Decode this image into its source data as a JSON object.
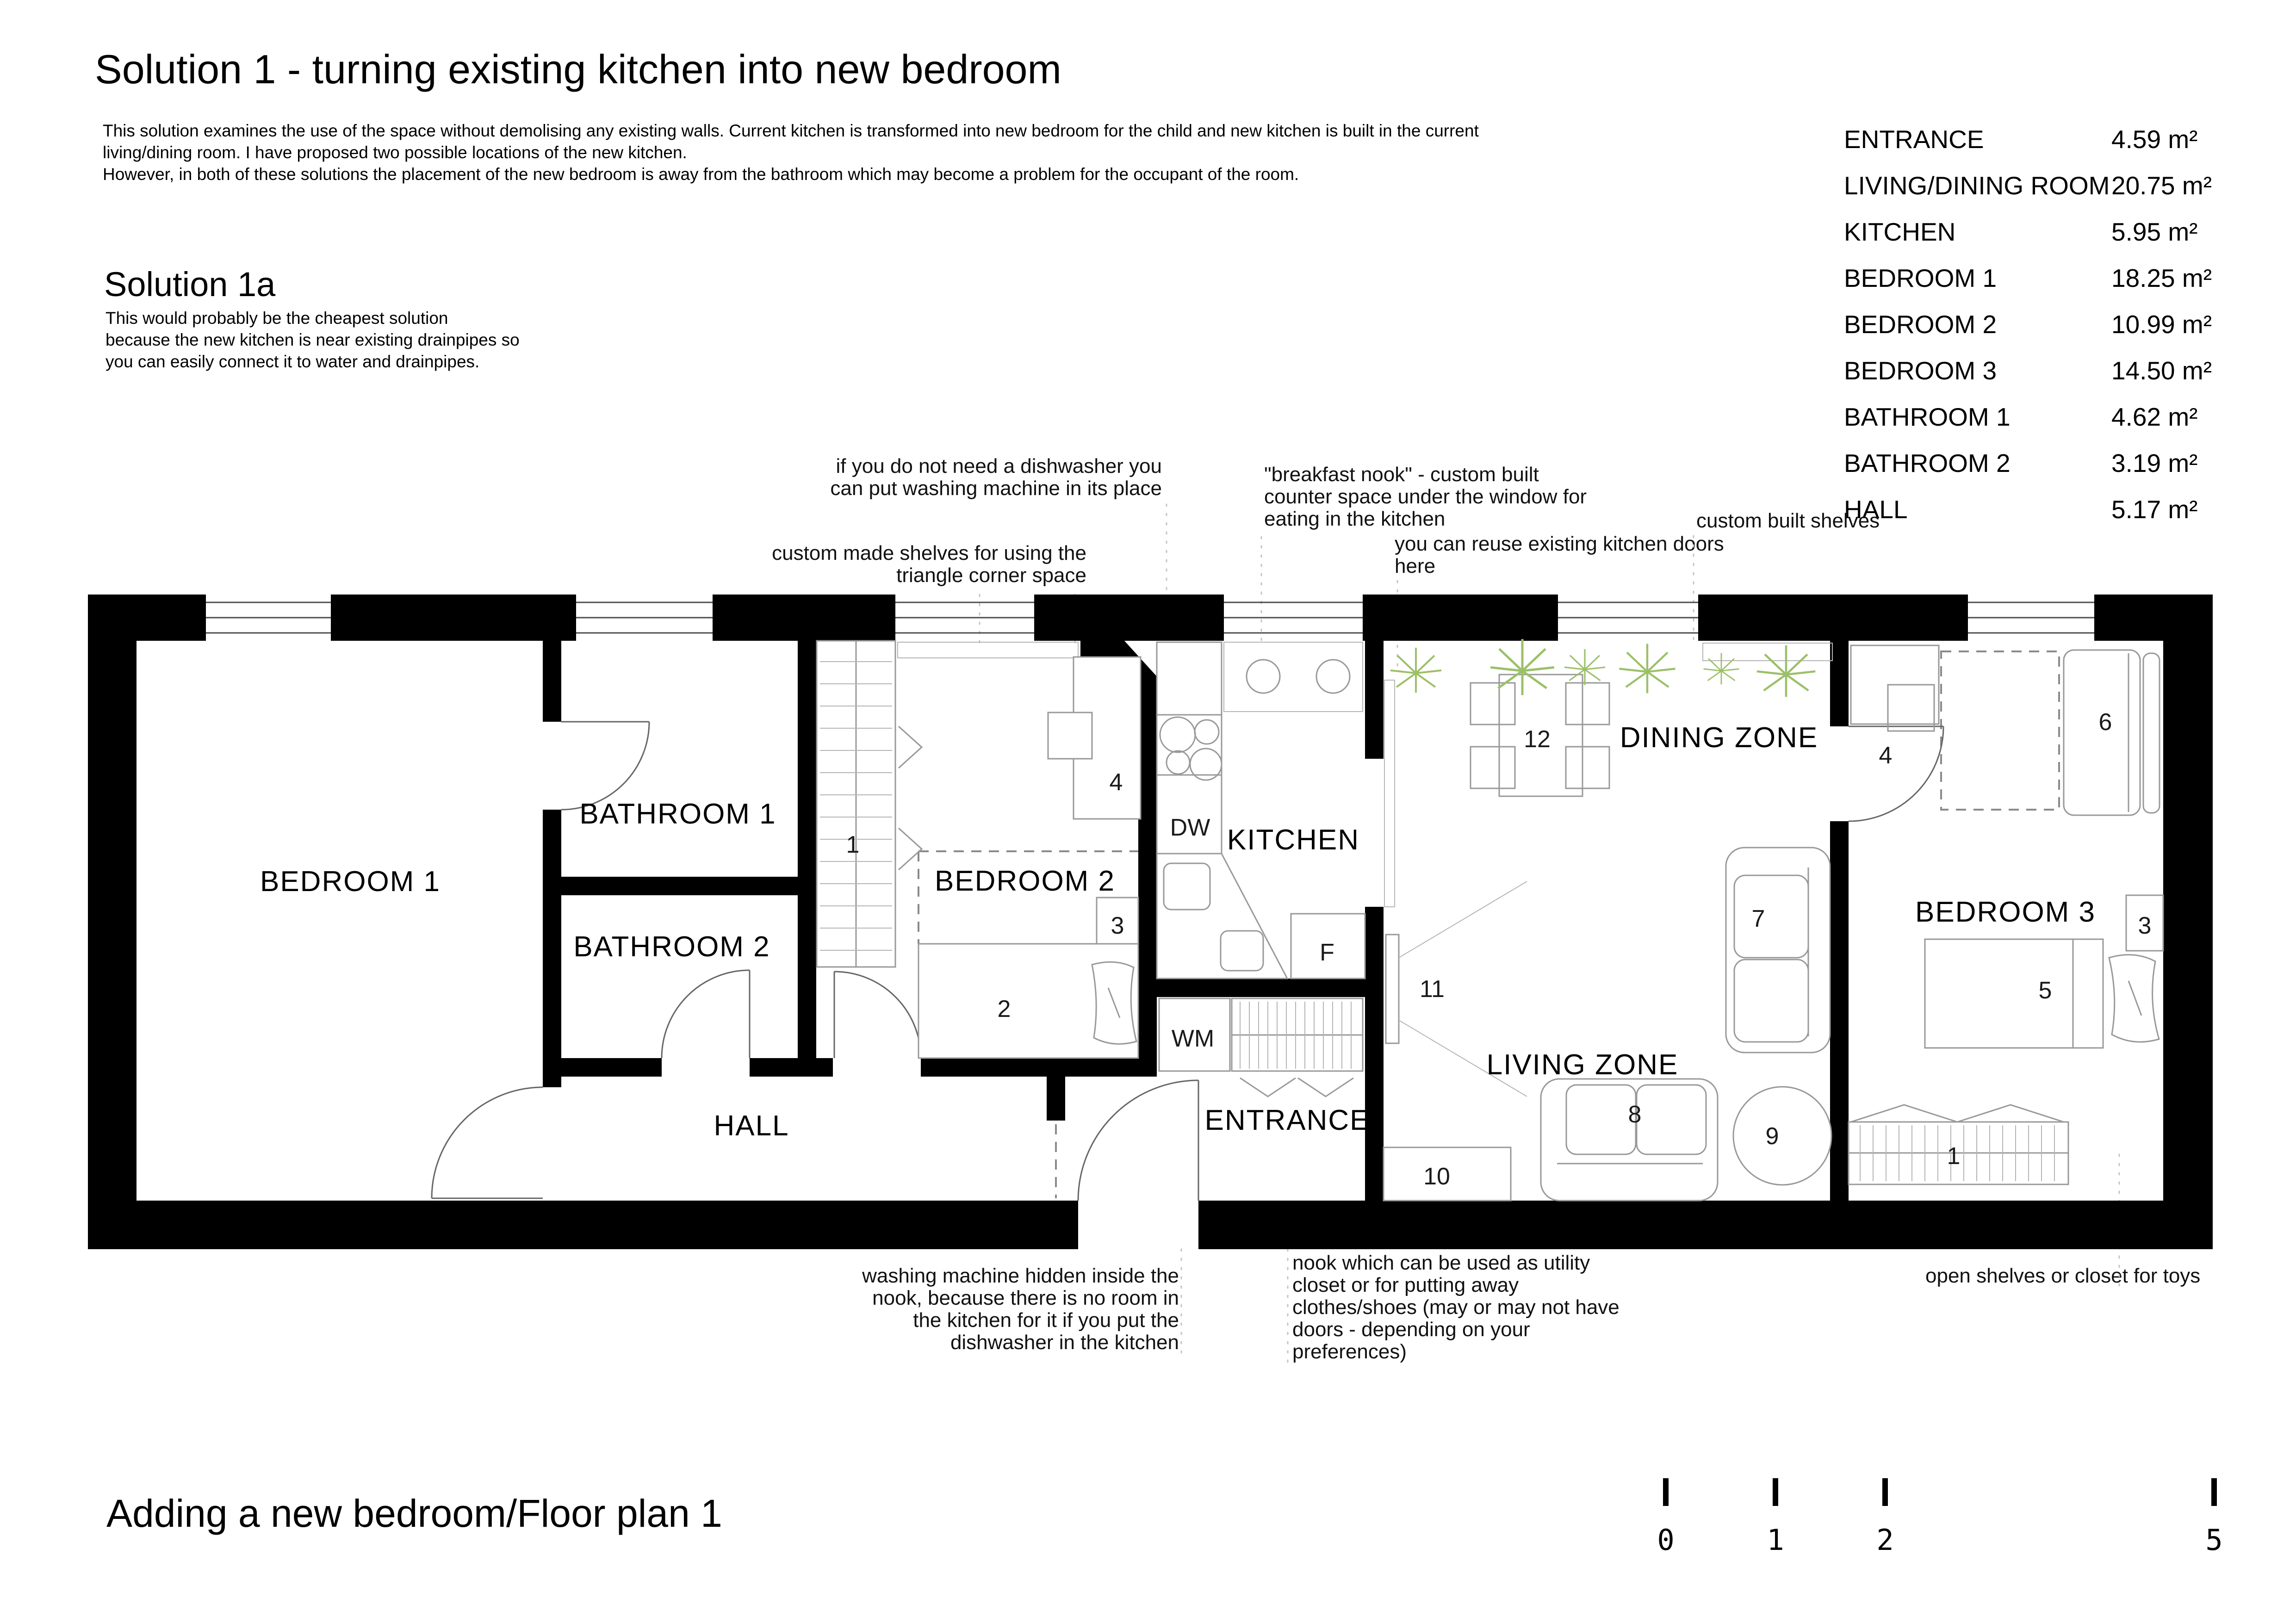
{
  "header": {
    "title": "Solution 1 - turning existing kitchen into new bedroom",
    "intro": [
      "This solution examines the use of the space without demolising any existing walls. Current kitchen is transformed into new bedroom for the child and new kitchen is built in the current",
      "living/dining room. I have proposed two possible locations of the new kitchen.",
      "However, in both of these solutions the placement of the new bedroom is away from the bathroom which may become a problem for the occupant of the room."
    ],
    "solution_1a_title": "Solution 1a",
    "solution_1a_lines": [
      "This would probably be the cheapest solution",
      "because the new kitchen is near existing drainpipes so",
      "you can easily connect it to water and drainpipes."
    ]
  },
  "areas": {
    "rows": [
      {
        "room": "ENTRANCE",
        "area": "4.59 m²"
      },
      {
        "room": "LIVING/DINING ROOM",
        "area": "20.75 m²"
      },
      {
        "room": "KITCHEN",
        "area": "5.95 m²"
      },
      {
        "room": "BEDROOM 1",
        "area": "18.25 m²"
      },
      {
        "room": "BEDROOM 2",
        "area": "10.99 m²"
      },
      {
        "room": "BEDROOM 3",
        "area": "14.50 m²"
      },
      {
        "room": "BATHROOM 1",
        "area": "4.62 m²"
      },
      {
        "room": "BATHROOM 2",
        "area": "3.19 m²"
      },
      {
        "room": "HALL",
        "area": "5.17 m²"
      }
    ]
  },
  "annotations": {
    "dishwasher": [
      "if you do not need a dishwasher you",
      "can put washing machine in its place"
    ],
    "corner_shelves": [
      "custom made shelves for using the",
      "triangle corner space"
    ],
    "breakfast_nook": [
      "\"breakfast nook\" - custom built",
      "counter space under the window for",
      "eating in the kitchen"
    ],
    "reuse_doors": [
      "you can reuse existing kitchen doors",
      "here"
    ],
    "custom_shelves": [
      "custom built shelves"
    ],
    "washing_machine": [
      "washing machine hidden inside the",
      "nook, because there is no room in",
      "the kitchen for it if you put the",
      "dishwasher in the kitchen"
    ],
    "nook_utility": [
      "nook which can be used as utility",
      "closet or for putting away",
      "clothes/shoes (may or may not have",
      "doors - depending on your",
      "preferences)"
    ],
    "open_shelves": [
      "open shelves or closet for toys"
    ]
  },
  "plan": {
    "rooms": {
      "bedroom1": "BEDROOM 1",
      "bathroom1": "BATHROOM 1",
      "bathroom2": "BATHROOM 2",
      "hall": "HALL",
      "bedroom2": "BEDROOM 2",
      "kitchen": "KITCHEN",
      "dining": "DINING ZONE",
      "living": "LIVING ZONE",
      "entrance": "ENTRANCE",
      "bedroom3": "BEDROOM 3"
    },
    "items": {
      "hall_closet": "1",
      "b2_desk": "4",
      "b2_shelf": "3",
      "b2_bed": "2",
      "dishwasher": "DW",
      "fridge": "F",
      "washing_machine": "WM",
      "tv": "11",
      "dining_table": "12",
      "sofa_large": "7",
      "sofa_small": "8",
      "coffee_table": "9",
      "entrance_cabinet": "10",
      "b3_desk": "4",
      "b3_bed": "6",
      "b3_nightstand": "3",
      "b3_daybed": "5",
      "b3_shelf": "1"
    }
  },
  "footer": {
    "title": "Adding a new bedroom/Floor plan 1",
    "scale_ticks": [
      "0",
      "1",
      "2",
      "5"
    ]
  },
  "colors": {
    "ink": "#000000",
    "furniture_line": "#999999",
    "plant": "#9cc069",
    "background": "#ffffff"
  }
}
